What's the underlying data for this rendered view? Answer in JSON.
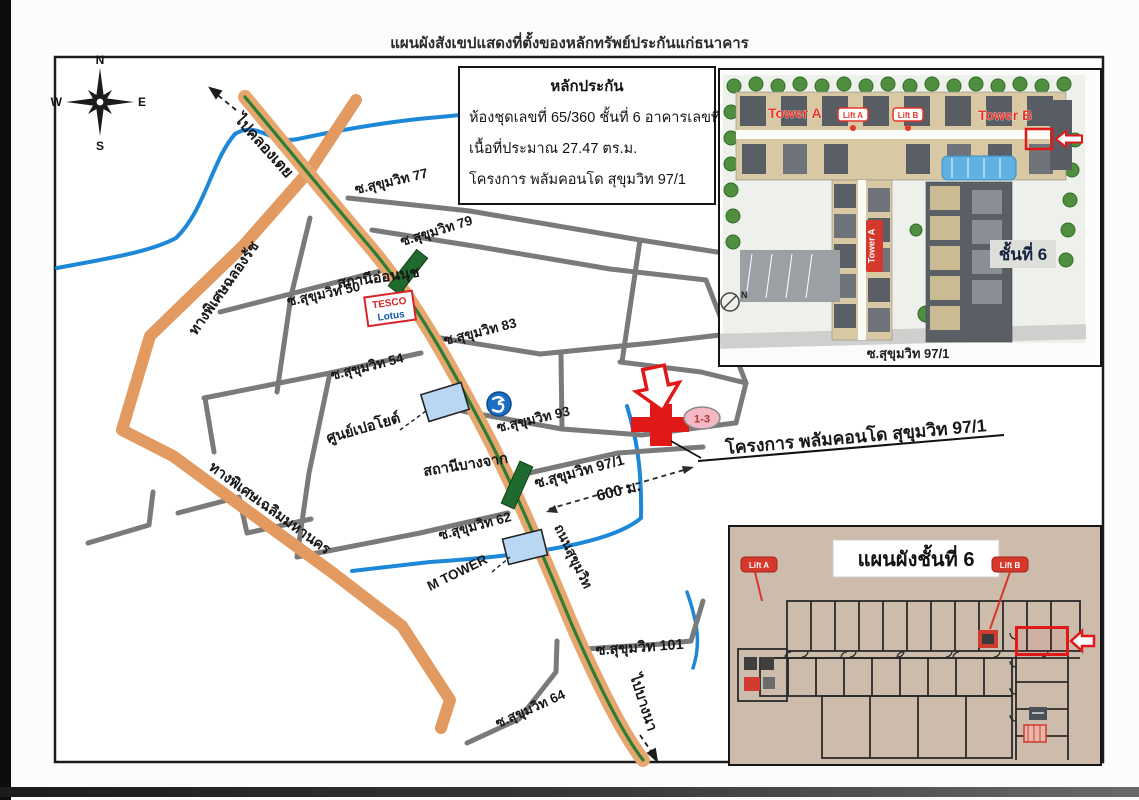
{
  "page": {
    "title": "แผนผังสังเขปแสดงที่ตั้งของหลักทรัพย์ประกันแก่ธนาคาร"
  },
  "collateral_box": {
    "heading": "หลักประกัน",
    "line1": "ห้องชุดเลขที่ 65/360  ชั้นที่ 6  อาคารเลขที่  B",
    "line2": "เนื้อที่ประมาณ  27.47 ตร.ม.",
    "line3": "โครงการ พลัมคอนโด สุขุมวิท 97/1"
  },
  "compass": {
    "n": "N",
    "e": "E",
    "s": "S",
    "w": "W"
  },
  "map": {
    "directions": {
      "to_khlong_toei": "ไปคลองเตย",
      "to_bang_na": "ไปบางนา"
    },
    "roads": {
      "sukhumvit_road": "ถนนสุขุมวิท",
      "chalong_rat_expressway": "ทางพิเศษฉลองรัช",
      "chalerm_mahanakhon_expressway": "ทางพิเศษเฉลิมมหานคร",
      "soi_50": "ซ.สุขุมวิท 50",
      "soi_54": "ซ.สุขุมวิท 54",
      "soi_62": "ซ.สุขุมวิท 62",
      "soi_64": "ซ.สุขุมวิท 64",
      "soi_77": "ซ.สุขุมวิท 77",
      "soi_79": "ซ.สุขุมวิท 79",
      "soi_83": "ซ.สุขุมวิท 83",
      "soi_93": "ซ.สุขุมวิท 93",
      "soi_97_1": "ซ.สุขุมวิท 97/1",
      "soi_101": "ซ.สุขุมวิท 101"
    },
    "stations": {
      "on_nut": "สถานีอ่อนนุช",
      "bang_chak": "สถานีบางจาก"
    },
    "places": {
      "tesco": "TESCO",
      "lotus": "Lotus",
      "peugeot_center": "ศูนย์เปอโยต์",
      "m_tower": "M TOWER"
    },
    "project": {
      "label": "โครงการ พลัมคอนโด สุขุมวิท 97/1",
      "unit_range": "1-3",
      "distance": "600 ม."
    }
  },
  "site_plan": {
    "tower_a": "Tower A",
    "tower_b": "Tower B",
    "tower_a_wing": "Tower A",
    "lift_a": "Lift A",
    "lift_b": "Lift B",
    "floor_badge": "ชั้นที่ 6",
    "road_label": "ซ.สุขุมวิท 97/1",
    "compass_n": "N"
  },
  "floor_plan": {
    "title": "แผนผังชั้นที่ 6",
    "lift_a": "Lift A",
    "lift_b": "Lift B"
  },
  "colors": {
    "highlight_red": "#e01818",
    "road_orange": "#e7a66e",
    "expressway_orange": "#e29a60",
    "median_green": "#2e7d33",
    "canal_blue": "#1d87d8",
    "station_green": "#1f6b2f",
    "building_blue": "#b9d7f2",
    "floorplan_tan": "#cdbbac"
  }
}
